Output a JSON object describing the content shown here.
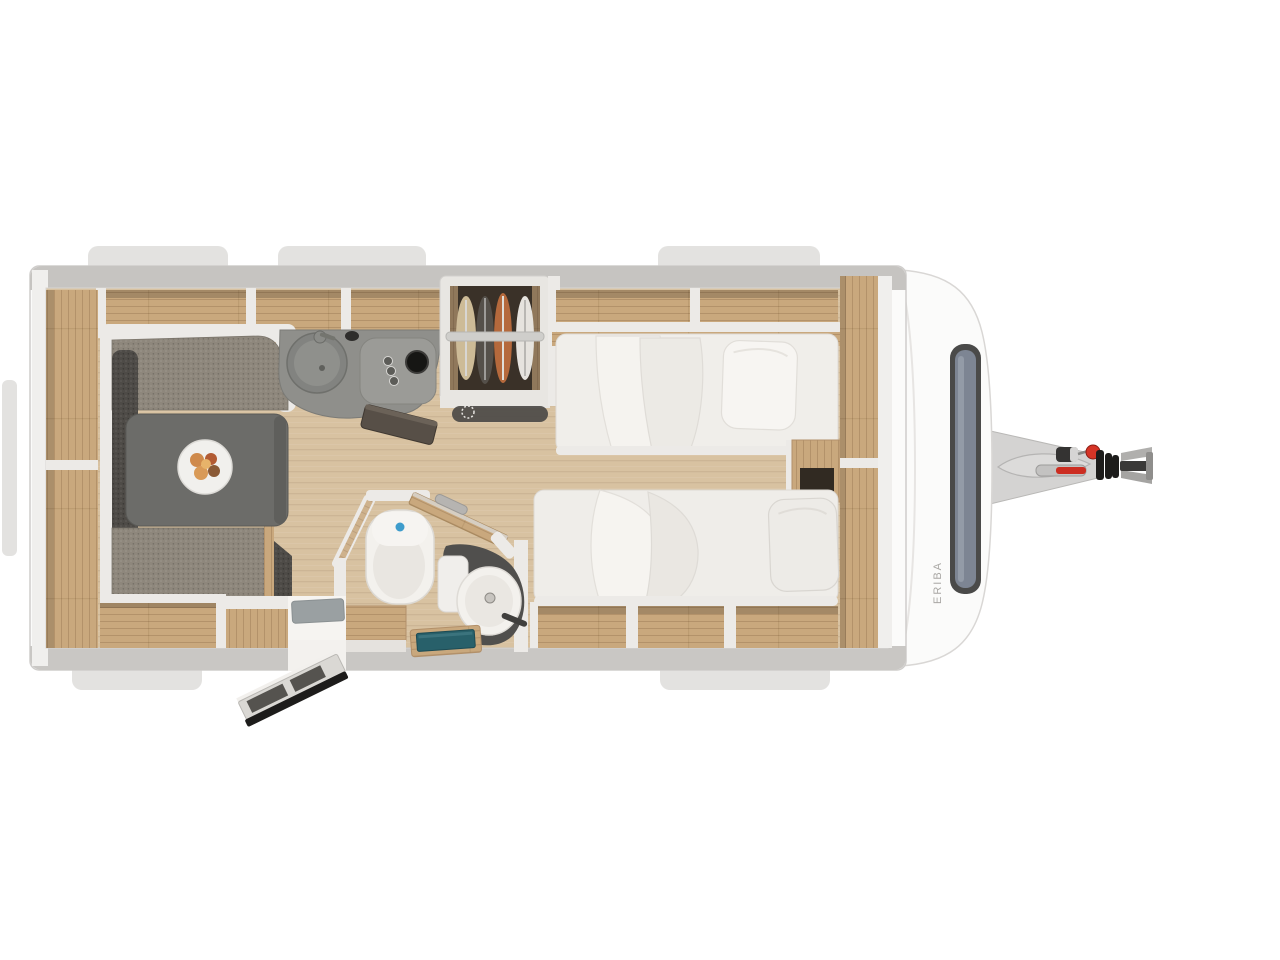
{
  "branding": {
    "side_label": "ERIBA"
  },
  "palette": {
    "body": "#fbfbfa",
    "wall": "#c6c4c1",
    "wall-light": "#f0efed",
    "panel": "#eceae7",
    "floor": "#d8c2a1",
    "wood": "#c9a87d",
    "cushion": "#8e877c",
    "cushion-dark": "#4e4b47",
    "table": "#6c6c69",
    "counter": "#8f8f8b",
    "fixture": "#f3f1ed",
    "basin-counter": "#504f4d",
    "teal": "#28606a",
    "mat": "#9aa0a2",
    "tab": "#e3e2e0",
    "glass": "#7d8593",
    "frame": "#4a4a49",
    "red": "#d63426",
    "dark": "#1d1c1b",
    "wardrobe-dark": "#3a3128",
    "rust": "#b5693c"
  },
  "scene": {
    "elements": [
      "caravan-body",
      "roof-vents",
      "overhead-lockers",
      "side-lockers",
      "dinette-bench-top",
      "dinette-bench-left",
      "dinette-bench-bottom",
      "dinette-table",
      "plate-with-food",
      "kitchen-counter",
      "kitchen-sink",
      "faucet",
      "gas-hob",
      "hob-knobs",
      "burner",
      "counter-flap",
      "wardrobe",
      "clothes-rail",
      "hanging-clothes",
      "bathroom",
      "toilet",
      "washbasin",
      "bathroom-door",
      "shower-tray",
      "storage-box",
      "single-bed-top",
      "single-bed-bottom",
      "pillow",
      "duvet",
      "bedside-shelf",
      "under-bed-storage",
      "front-sideboard",
      "entry-doorway",
      "door-mat",
      "entry-step",
      "front-cap",
      "front-window",
      "brand-label",
      "drawbar",
      "jockey-wheel-clamp",
      "handbrake-lever",
      "red-knob",
      "hitch-coupling"
    ]
  }
}
